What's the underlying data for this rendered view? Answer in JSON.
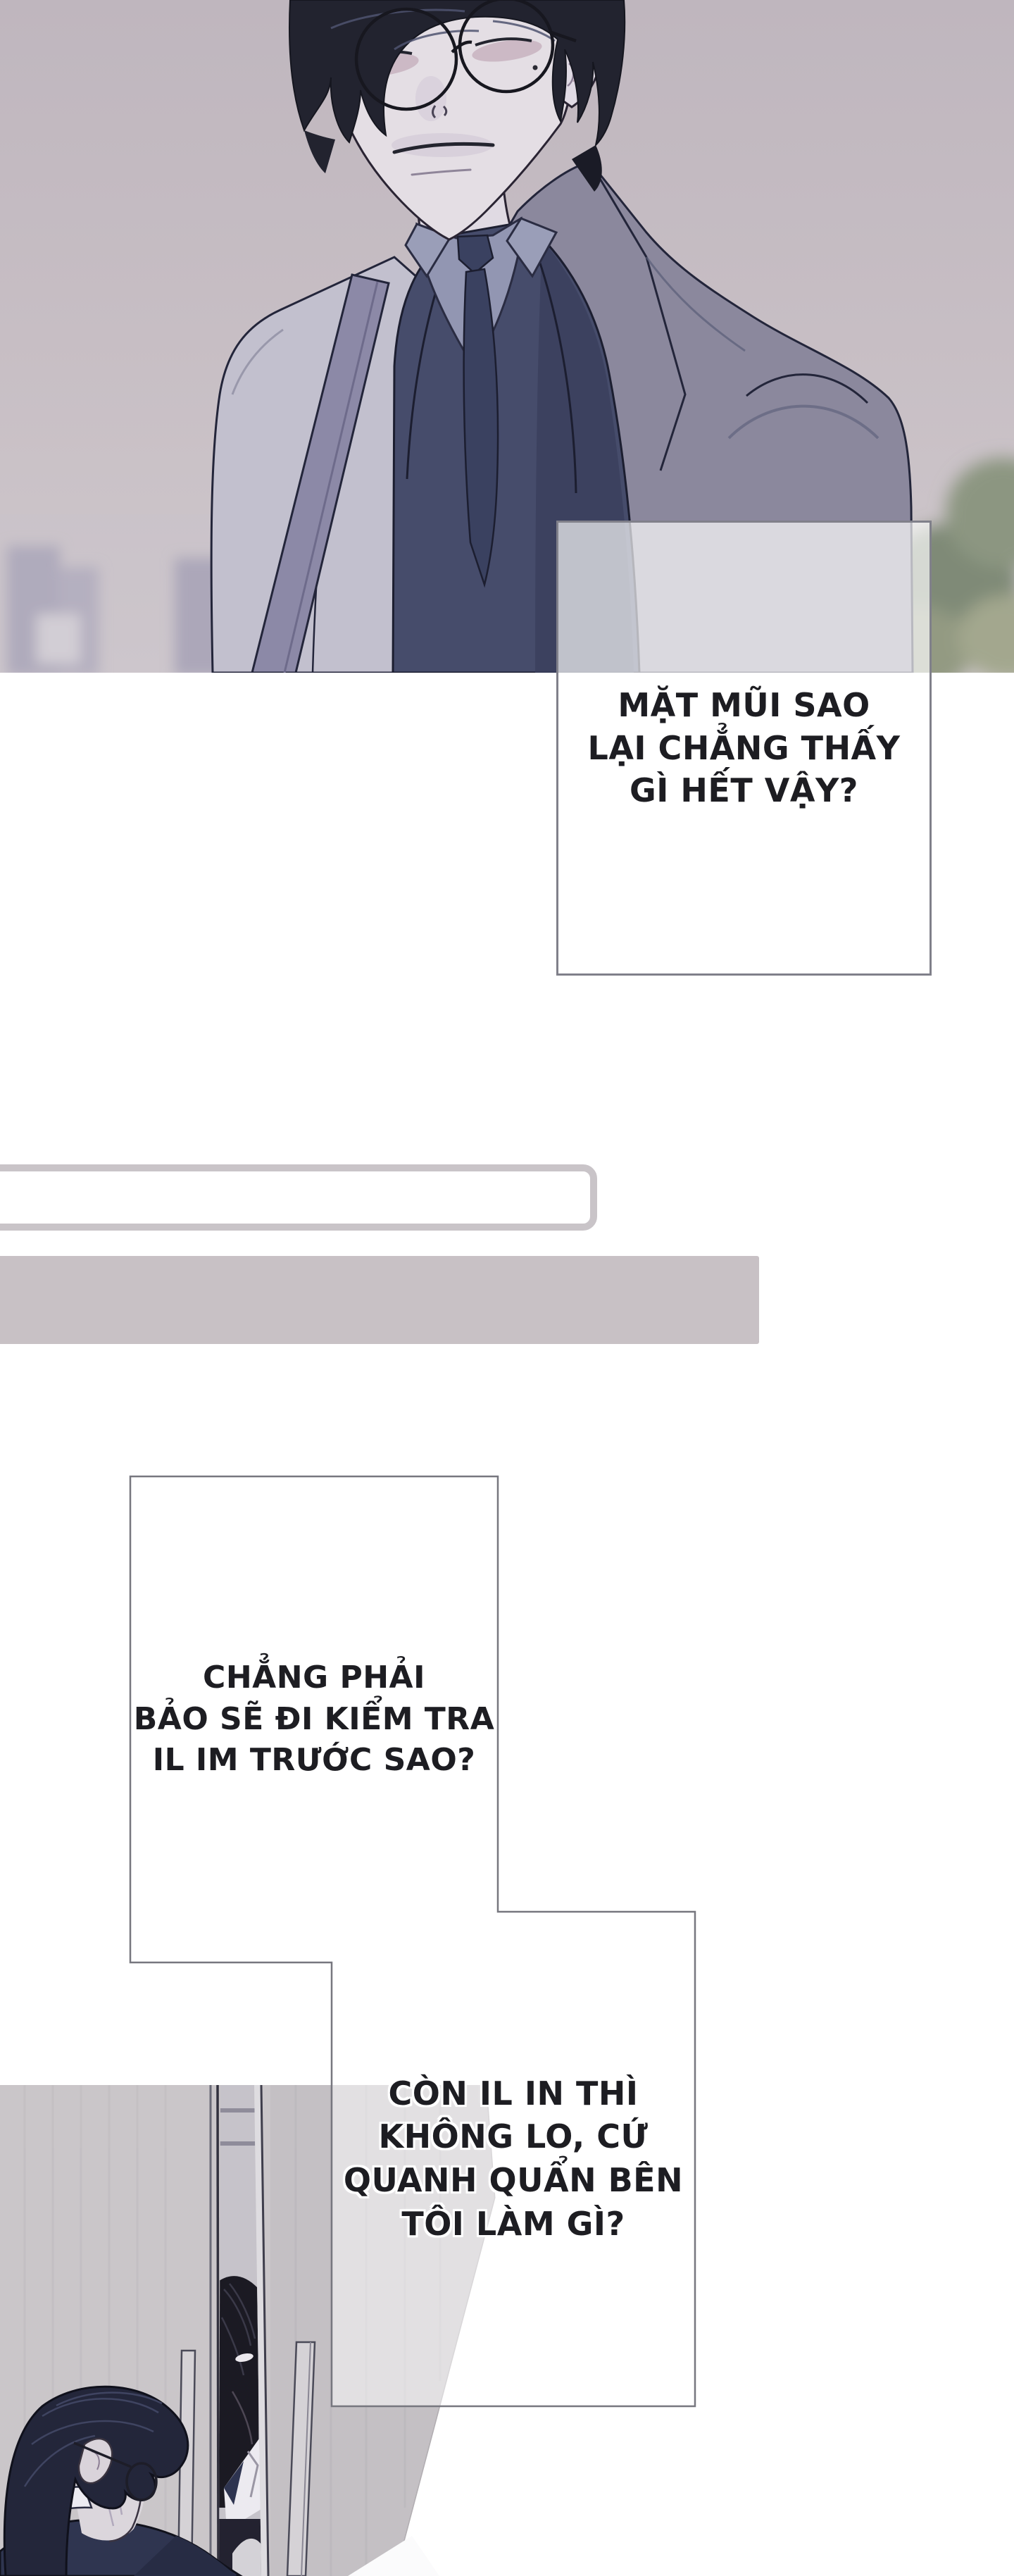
{
  "page": {
    "kind": "webtoon comic page",
    "background": "#ffffff"
  },
  "bubbles": {
    "b1": {
      "text": "MẶT MŨI SAO\nLẠI CHẲNG THẤY\nGÌ HẾT VẬY?"
    },
    "b2": {
      "text": "CHẲNG PHẢI\nBẢO SẼ ĐI KIỂM TRA\nIL IM TRƯỚC SAO?"
    },
    "b3": {
      "text": "CÒN IL IN THÌ\nKHÔNG LO, CỨ\nQUANH QUẨN BÊN\nTÔI LÀM GÌ?"
    }
  },
  "colors": {
    "page_bg": "#ffffff",
    "text": "#1d1d22",
    "bubble_border": "#80808a",
    "bubble_fill_translucent": "rgba(255,255,255,0.6)",
    "divider_box_border": "#c9c4c8",
    "divider_bar_fill": "#c8c1c5",
    "panel_sky_top": "#bfb6be",
    "panel_sky_bottom": "#cfc8cc",
    "skyline": "#a29eb4",
    "bush_green": "#7f8a77",
    "hair": "#22232f",
    "skin": "#e4dee4",
    "shirt": "#9296b2",
    "suit_dark": "#464c6b",
    "tie": "#3a4160",
    "coat_light": "#c2c0ce",
    "coat_shadow": "#8b889d",
    "strap": "#8c89a7",
    "wall": "#cac6c9",
    "door_gap_dark": "#1b1a23"
  }
}
